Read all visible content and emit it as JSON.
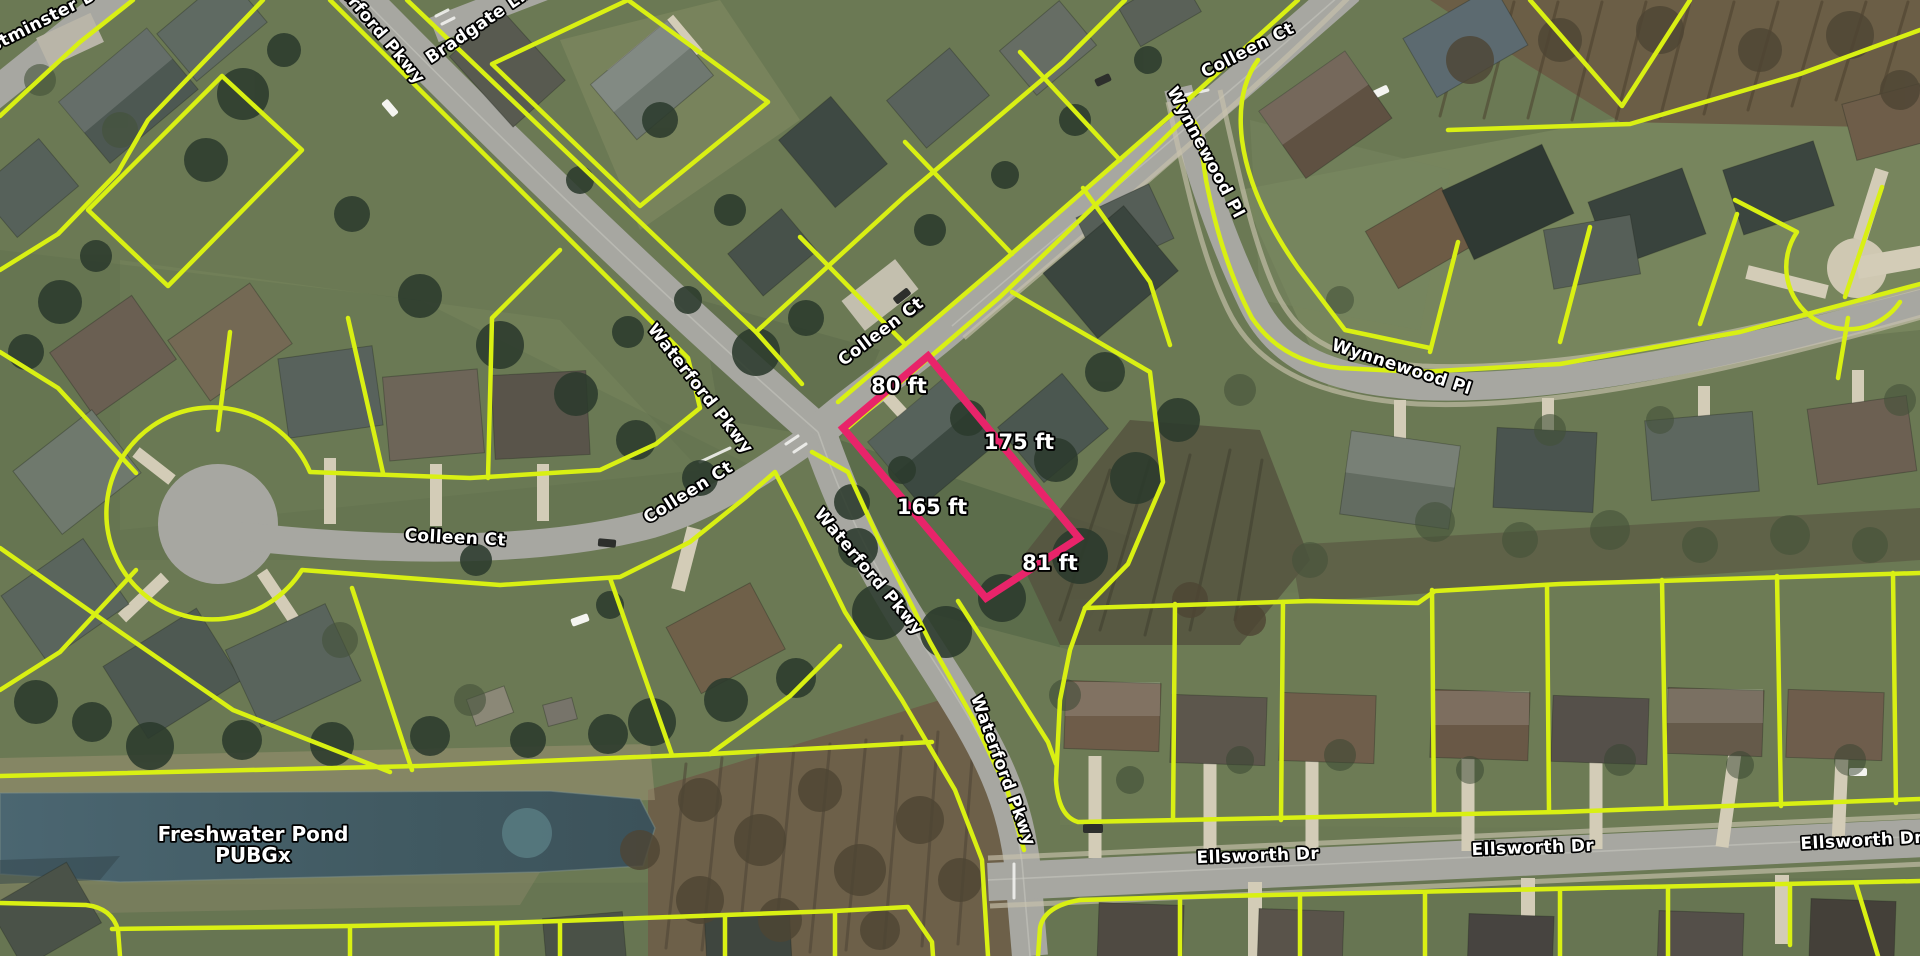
{
  "map": {
    "type": "aerial-parcel-map",
    "colors": {
      "parcel_line": "#d9f013",
      "highlight_parcel": "#e8246a",
      "road": "#a7a7a1",
      "driveway": "#d3ccb7",
      "water": "#49636e"
    },
    "highlight_parcel": {
      "points": "928,356 1079,538 986,598 843,428",
      "dimension_labels": [
        {
          "text": "80 ft",
          "x": 899,
          "y": 393
        },
        {
          "text": "175 ft",
          "x": 1019,
          "y": 449
        },
        {
          "text": "165 ft",
          "x": 932,
          "y": 514
        },
        {
          "text": "81 ft",
          "x": 1050,
          "y": 570
        }
      ]
    },
    "street_labels": [
      {
        "text": "Westminster Dr",
        "x": 36,
        "y": 30,
        "rot": -27
      },
      {
        "text": "Waterford Pkwy",
        "x": 366,
        "y": 24,
        "rot": 50
      },
      {
        "text": "Bradgate Ln",
        "x": 481,
        "y": 30,
        "rot": -34
      },
      {
        "text": "Colleen Ct",
        "x": 1250,
        "y": 55,
        "rot": -27
      },
      {
        "text": "Wynnewood Pl",
        "x": 1201,
        "y": 155,
        "rot": 62
      },
      {
        "text": "Wynnewood Pl",
        "x": 1400,
        "y": 372,
        "rot": 18
      },
      {
        "text": "Colleen Ct",
        "x": 884,
        "y": 336,
        "rot": -37
      },
      {
        "text": "Waterford Pkwy",
        "x": 696,
        "y": 392,
        "rot": 52
      },
      {
        "text": "Colleen Ct",
        "x": 455,
        "y": 543,
        "rot": 3
      },
      {
        "text": "Colleen Ct",
        "x": 691,
        "y": 497,
        "rot": -32
      },
      {
        "text": "Waterford Pkwy",
        "x": 865,
        "y": 575,
        "rot": 50
      },
      {
        "text": "Waterford Pkwy",
        "x": 998,
        "y": 772,
        "rot": 70
      },
      {
        "text": "Ellsworth Dr",
        "x": 1258,
        "y": 861,
        "rot": -2
      },
      {
        "text": "Ellsworth Dr",
        "x": 1533,
        "y": 853,
        "rot": -2
      },
      {
        "text": "Ellsworth Dr",
        "x": 1862,
        "y": 846,
        "rot": -3
      }
    ],
    "water_label": {
      "lines": [
        "Freshwater Pond",
        "PUBGx"
      ],
      "x": 253,
      "y": 841,
      "line_height": 21
    }
  }
}
